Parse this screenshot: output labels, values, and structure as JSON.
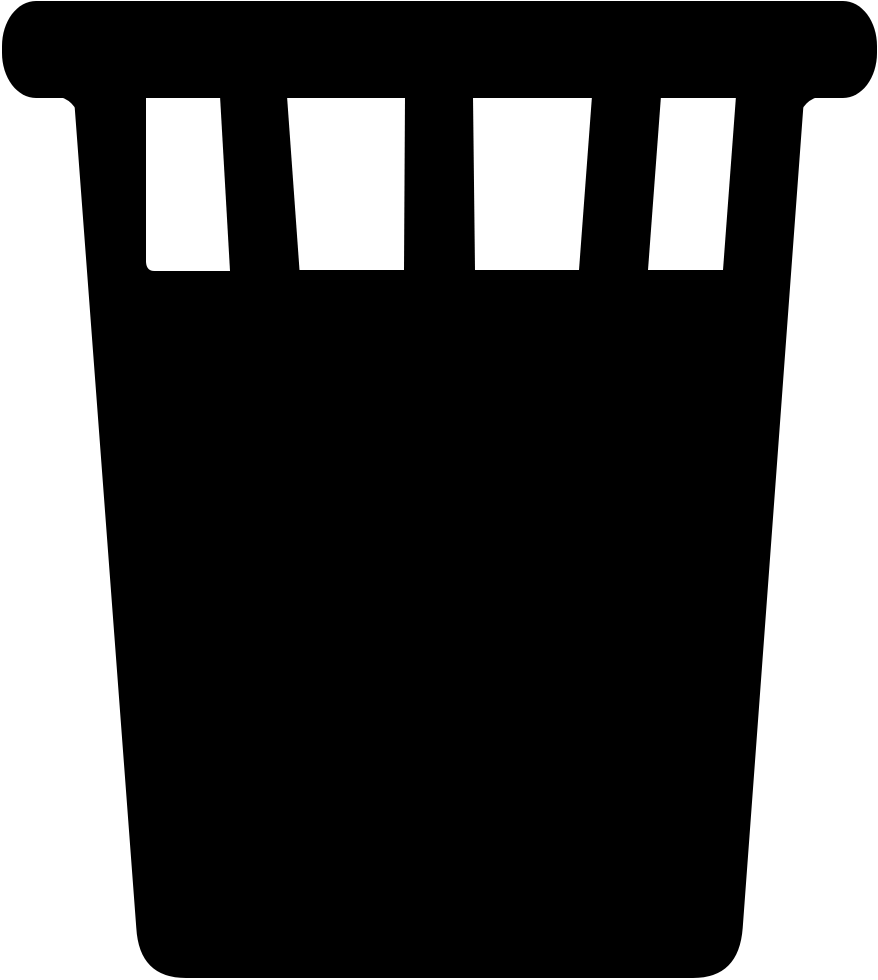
{
  "page": {
    "background_color": "#ffffff",
    "width_px": 878,
    "height_px": 980
  },
  "icon": {
    "name": "trash-basket",
    "description": "Black silhouette icon of a tapered waste basket (trash can) with a rounded top rim bar and four vertical vent slots below the rim",
    "color": "#000000",
    "slot_color": "#ffffff",
    "slot_count": 4
  }
}
